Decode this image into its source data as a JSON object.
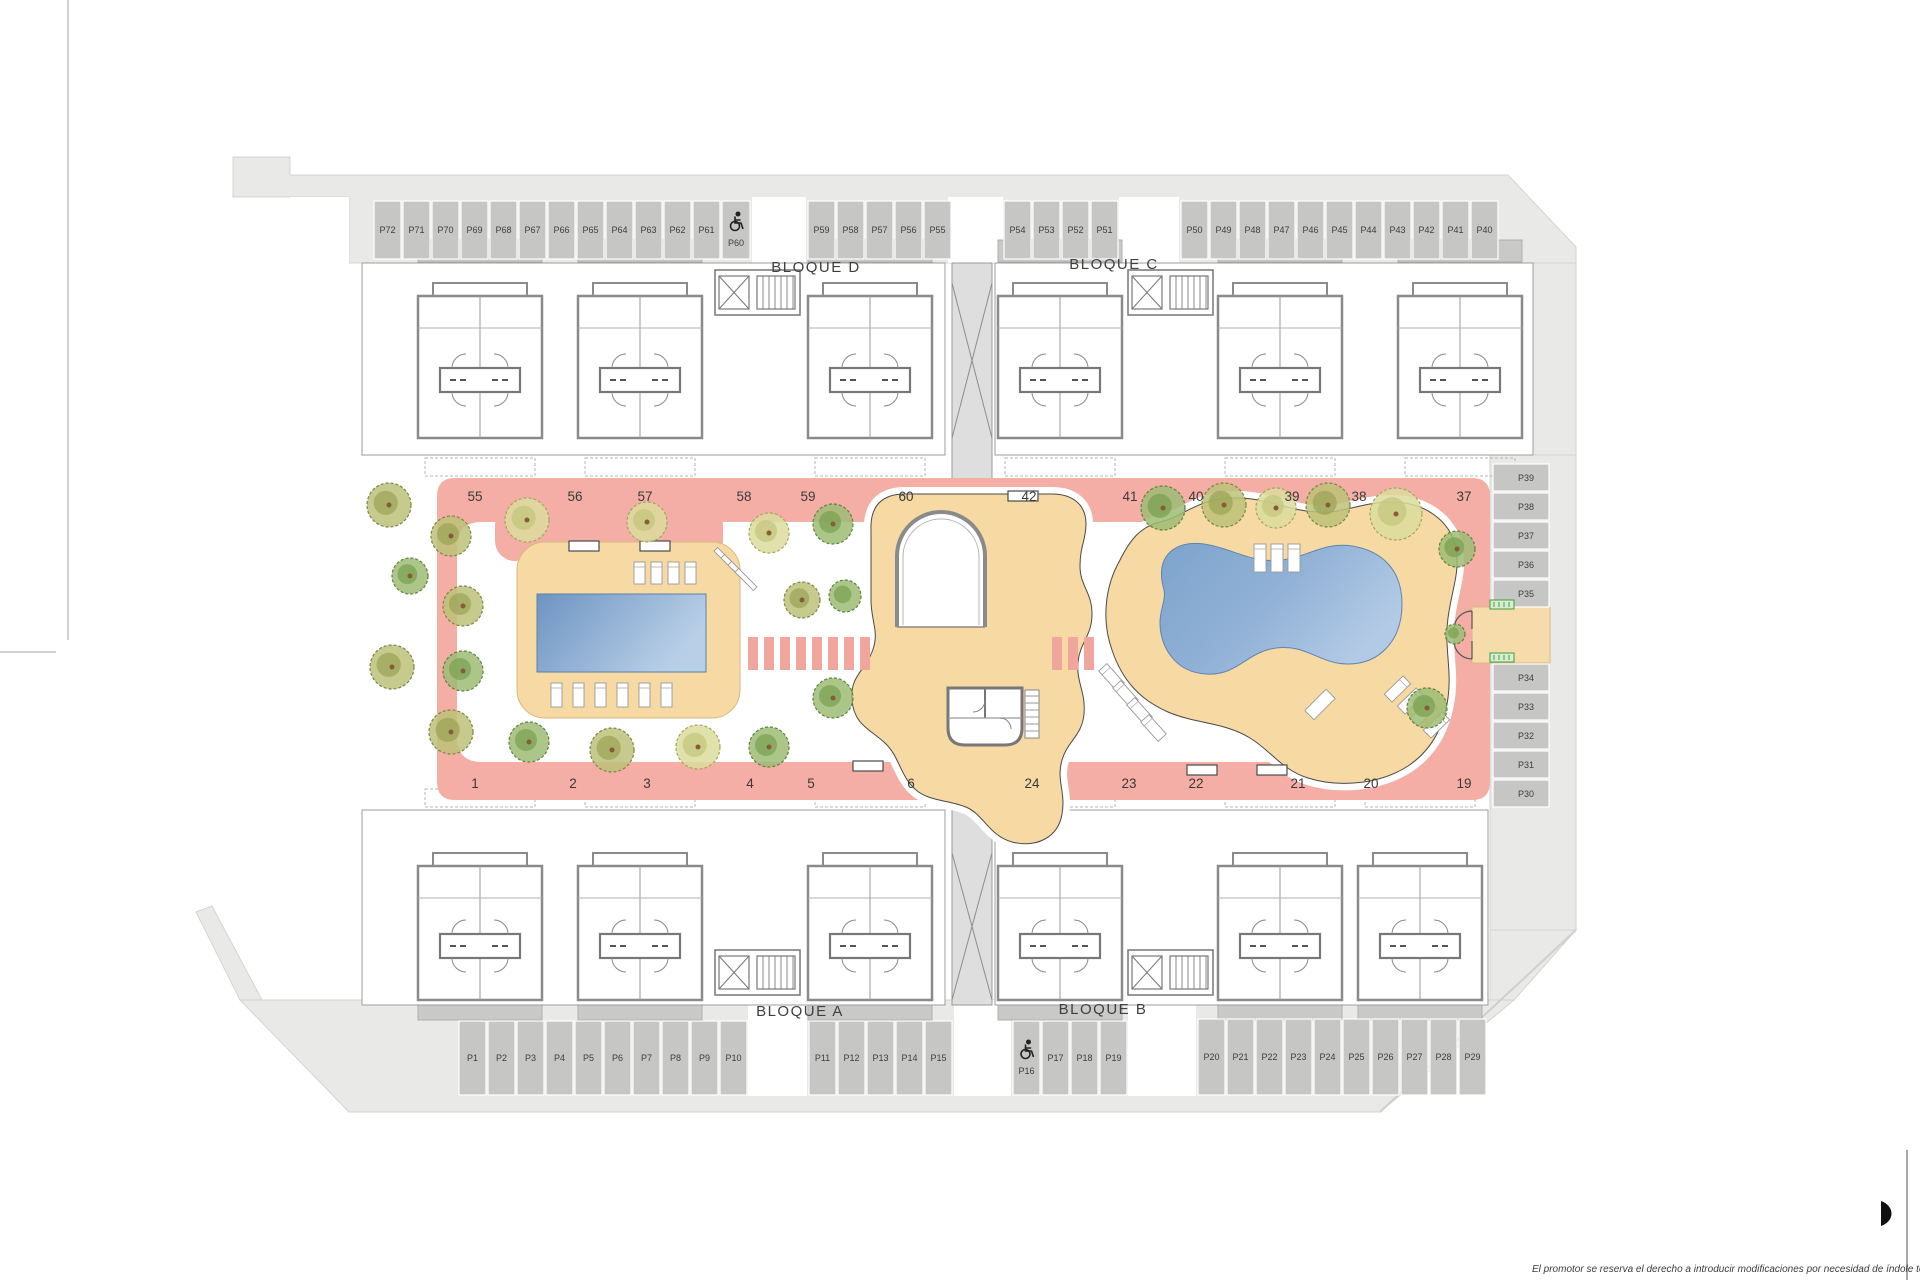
{
  "plan": {
    "block_labels": [
      {
        "id": "bloque-d",
        "label": "BLOQUE D",
        "x": 816,
        "y": 272
      },
      {
        "id": "bloque-c",
        "label": "BLOQUE C",
        "x": 1114,
        "y": 269
      },
      {
        "id": "bloque-a",
        "label": "BLOQUE A",
        "x": 800,
        "y": 1016
      },
      {
        "id": "bloque-b",
        "label": "BLOQUE B",
        "x": 1103,
        "y": 1014
      }
    ],
    "walkway_numbers": {
      "top_y": 501,
      "top": [
        {
          "n": "55",
          "x": 475
        },
        {
          "n": "56",
          "x": 575
        },
        {
          "n": "57",
          "x": 645
        },
        {
          "n": "58",
          "x": 744
        },
        {
          "n": "59",
          "x": 808
        },
        {
          "n": "60",
          "x": 906
        },
        {
          "n": "42",
          "x": 1029
        },
        {
          "n": "41",
          "x": 1130
        },
        {
          "n": "40",
          "x": 1196
        },
        {
          "n": "39",
          "x": 1292
        },
        {
          "n": "38",
          "x": 1359
        },
        {
          "n": "37",
          "x": 1464
        }
      ],
      "bottom_y": 788,
      "bottom": [
        {
          "n": "1",
          "x": 475
        },
        {
          "n": "2",
          "x": 573
        },
        {
          "n": "3",
          "x": 647
        },
        {
          "n": "4",
          "x": 750
        },
        {
          "n": "5",
          "x": 811
        },
        {
          "n": "6",
          "x": 911
        },
        {
          "n": "24",
          "x": 1032
        },
        {
          "n": "23",
          "x": 1129
        },
        {
          "n": "22",
          "x": 1196
        },
        {
          "n": "21",
          "x": 1298
        },
        {
          "n": "20",
          "x": 1371
        },
        {
          "n": "19",
          "x": 1464
        }
      ]
    },
    "parking": {
      "groups": [
        {
          "id": "top-row-a",
          "orient": "h",
          "x": 373,
          "y": 200,
          "stall_w": 29,
          "stall_h": 60,
          "labels": [
            "P72",
            "P71",
            "P70",
            "P69",
            "P68",
            "P67",
            "P66",
            "P65",
            "P64",
            "P63",
            "P62",
            "P61"
          ]
        },
        {
          "id": "top-row-hc",
          "orient": "h",
          "x": 721,
          "y": 200,
          "stall_w": 30,
          "stall_h": 60,
          "labels": [
            "P60"
          ],
          "handicap": true
        },
        {
          "id": "top-row-b",
          "orient": "h",
          "x": 807,
          "y": 200,
          "stall_w": 29,
          "stall_h": 60,
          "labels": [
            "P59",
            "P58",
            "P57",
            "P56",
            "P55"
          ]
        },
        {
          "id": "top-row-c",
          "orient": "h",
          "x": 1003,
          "y": 200,
          "stall_w": 29,
          "stall_h": 60,
          "labels": [
            "P54",
            "P53",
            "P52",
            "P51"
          ]
        },
        {
          "id": "top-row-d",
          "orient": "h",
          "x": 1180,
          "y": 200,
          "stall_w": 29,
          "stall_h": 60,
          "labels": [
            "P50",
            "P49",
            "P48",
            "P47",
            "P46",
            "P45",
            "P44",
            "P43",
            "P42",
            "P41",
            "P40"
          ]
        },
        {
          "id": "bottom-row-a",
          "orient": "h",
          "x": 458,
          "y": 1020,
          "stall_w": 29,
          "stall_h": 76,
          "labels": [
            "P1",
            "P2",
            "P3",
            "P4",
            "P5",
            "P6",
            "P7",
            "P8",
            "P9",
            "P10"
          ]
        },
        {
          "id": "bottom-row-b",
          "orient": "h",
          "x": 808,
          "y": 1020,
          "stall_w": 29,
          "stall_h": 76,
          "labels": [
            "P11",
            "P12",
            "P13",
            "P14",
            "P15"
          ]
        },
        {
          "id": "bottom-row-c",
          "orient": "h",
          "x": 1012,
          "y": 1020,
          "stall_w": 29,
          "stall_h": 76,
          "labels": [
            "P16",
            "P17",
            "P18",
            "P19"
          ],
          "handicap": true
        },
        {
          "id": "bottom-row-d",
          "orient": "h",
          "x": 1197,
          "y": 1018,
          "stall_w": 29,
          "stall_h": 78,
          "labels": [
            "P20",
            "P21",
            "P22",
            "P23",
            "P24",
            "P25",
            "P26",
            "P27",
            "P28",
            "P29"
          ]
        },
        {
          "id": "right-col-a",
          "orient": "v",
          "x": 1492,
          "y": 463,
          "stall_w": 58,
          "stall_h": 29,
          "labels": [
            "P39",
            "P38",
            "P37",
            "P36",
            "P35"
          ]
        },
        {
          "id": "right-col-b",
          "orient": "v",
          "x": 1492,
          "y": 663,
          "stall_w": 58,
          "stall_h": 29,
          "labels": [
            "P34",
            "P33",
            "P32",
            "P31",
            "P30"
          ]
        }
      ]
    },
    "trees": [
      {
        "x": 389,
        "y": 505,
        "r": 22,
        "v": 1
      },
      {
        "x": 451,
        "y": 536,
        "r": 20,
        "v": 1
      },
      {
        "x": 527,
        "y": 520,
        "r": 22,
        "v": 3
      },
      {
        "x": 647,
        "y": 522,
        "r": 20,
        "v": 3
      },
      {
        "x": 410,
        "y": 576,
        "r": 18,
        "v": 2
      },
      {
        "x": 463,
        "y": 606,
        "r": 20,
        "v": 1
      },
      {
        "x": 392,
        "y": 667,
        "r": 22,
        "v": 1
      },
      {
        "x": 463,
        "y": 671,
        "r": 20,
        "v": 2
      },
      {
        "x": 451,
        "y": 732,
        "r": 22,
        "v": 1
      },
      {
        "x": 529,
        "y": 742,
        "r": 20,
        "v": 2
      },
      {
        "x": 612,
        "y": 750,
        "r": 22,
        "v": 1
      },
      {
        "x": 698,
        "y": 747,
        "r": 22,
        "v": 3
      },
      {
        "x": 769,
        "y": 747,
        "r": 20,
        "v": 2
      },
      {
        "x": 769,
        "y": 533,
        "r": 20,
        "v": 3
      },
      {
        "x": 833,
        "y": 524,
        "r": 20,
        "v": 2
      },
      {
        "x": 802,
        "y": 600,
        "r": 18,
        "v": 1
      },
      {
        "x": 845,
        "y": 596,
        "r": 16,
        "v": 2
      },
      {
        "x": 833,
        "y": 698,
        "r": 20,
        "v": 2
      },
      {
        "x": 1163,
        "y": 508,
        "r": 22,
        "v": 2
      },
      {
        "x": 1224,
        "y": 505,
        "r": 22,
        "v": 1
      },
      {
        "x": 1276,
        "y": 508,
        "r": 20,
        "v": 3
      },
      {
        "x": 1328,
        "y": 505,
        "r": 22,
        "v": 1
      },
      {
        "x": 1396,
        "y": 514,
        "r": 26,
        "v": 3
      },
      {
        "x": 1457,
        "y": 549,
        "r": 18,
        "v": 2
      },
      {
        "x": 1427,
        "y": 708,
        "r": 20,
        "v": 2
      },
      {
        "x": 1455,
        "y": 634,
        "r": 10,
        "v": 2
      }
    ],
    "benches": [
      {
        "x": 584,
        "y": 546
      },
      {
        "x": 655,
        "y": 546
      },
      {
        "x": 1023,
        "y": 496
      },
      {
        "x": 868,
        "y": 766
      },
      {
        "x": 1202,
        "y": 770
      },
      {
        "x": 1272,
        "y": 770
      }
    ],
    "loungers": [
      {
        "x": 634,
        "y": 562,
        "w": 11,
        "h": 22,
        "rot": 0
      },
      {
        "x": 651,
        "y": 562,
        "w": 11,
        "h": 22,
        "rot": 0
      },
      {
        "x": 668,
        "y": 562,
        "w": 11,
        "h": 22,
        "rot": 0
      },
      {
        "x": 685,
        "y": 562,
        "w": 11,
        "h": 22,
        "rot": 0
      },
      {
        "x": 551,
        "y": 683,
        "w": 11,
        "h": 24,
        "rot": 0
      },
      {
        "x": 573,
        "y": 683,
        "w": 11,
        "h": 24,
        "rot": 0
      },
      {
        "x": 595,
        "y": 683,
        "w": 11,
        "h": 24,
        "rot": 0
      },
      {
        "x": 617,
        "y": 683,
        "w": 11,
        "h": 24,
        "rot": 0
      },
      {
        "x": 639,
        "y": 683,
        "w": 11,
        "h": 24,
        "rot": 0
      },
      {
        "x": 661,
        "y": 683,
        "w": 11,
        "h": 24,
        "rot": 0
      },
      {
        "x": 712,
        "y": 556,
        "w": 26,
        "h": 5,
        "rot": 45
      },
      {
        "x": 719,
        "y": 563,
        "w": 26,
        "h": 5,
        "rot": 45
      },
      {
        "x": 726,
        "y": 570,
        "w": 26,
        "h": 5,
        "rot": 45
      },
      {
        "x": 733,
        "y": 577,
        "w": 26,
        "h": 5,
        "rot": 45
      },
      {
        "x": 1254,
        "y": 544,
        "w": 12,
        "h": 28,
        "rot": 0
      },
      {
        "x": 1271,
        "y": 544,
        "w": 12,
        "h": 28,
        "rot": 0
      },
      {
        "x": 1288,
        "y": 544,
        "w": 12,
        "h": 28,
        "rot": 0
      },
      {
        "x": 1106,
        "y": 664,
        "w": 11,
        "h": 26,
        "rot": -42
      },
      {
        "x": 1120,
        "y": 681,
        "w": 11,
        "h": 26,
        "rot": -42
      },
      {
        "x": 1134,
        "y": 698,
        "w": 11,
        "h": 26,
        "rot": -42
      },
      {
        "x": 1148,
        "y": 715,
        "w": 11,
        "h": 26,
        "rot": -42
      },
      {
        "x": 1392,
        "y": 676,
        "w": 11,
        "h": 26,
        "rot": 46
      },
      {
        "x": 1405,
        "y": 688,
        "w": 11,
        "h": 26,
        "rot": 46
      },
      {
        "x": 1418,
        "y": 700,
        "w": 11,
        "h": 26,
        "rot": 46
      },
      {
        "x": 1431,
        "y": 712,
        "w": 11,
        "h": 26,
        "rot": 46
      },
      {
        "x": 1305,
        "y": 698,
        "w": 30,
        "h": 13,
        "rot": -45
      }
    ],
    "entrance_signs": [
      {
        "x": 1490,
        "y": 600
      },
      {
        "x": 1490,
        "y": 653
      }
    ],
    "disclaimer": "El promotor se reserva el derecho a introducir modificaciones por necesidad de índole técnica o legal",
    "colors": {
      "street_band": "#e9e9e8",
      "stall": "#c6c6c5",
      "stall_text": "#3d3d3d",
      "walkway_pink": "#f4aea6",
      "crosswalk_pink": "#f0a59d",
      "deck_beige": "#f6d9a3",
      "pool_dark": "#6d94c2",
      "pool_light": "#b9cfe7",
      "pool2_dark": "#7da3cd",
      "pool2_light": "#b3cae6",
      "wall_gray": "#8a8a8a",
      "label_gray": "#3a3a3a",
      "sign_green": "#3f9e3f"
    }
  }
}
